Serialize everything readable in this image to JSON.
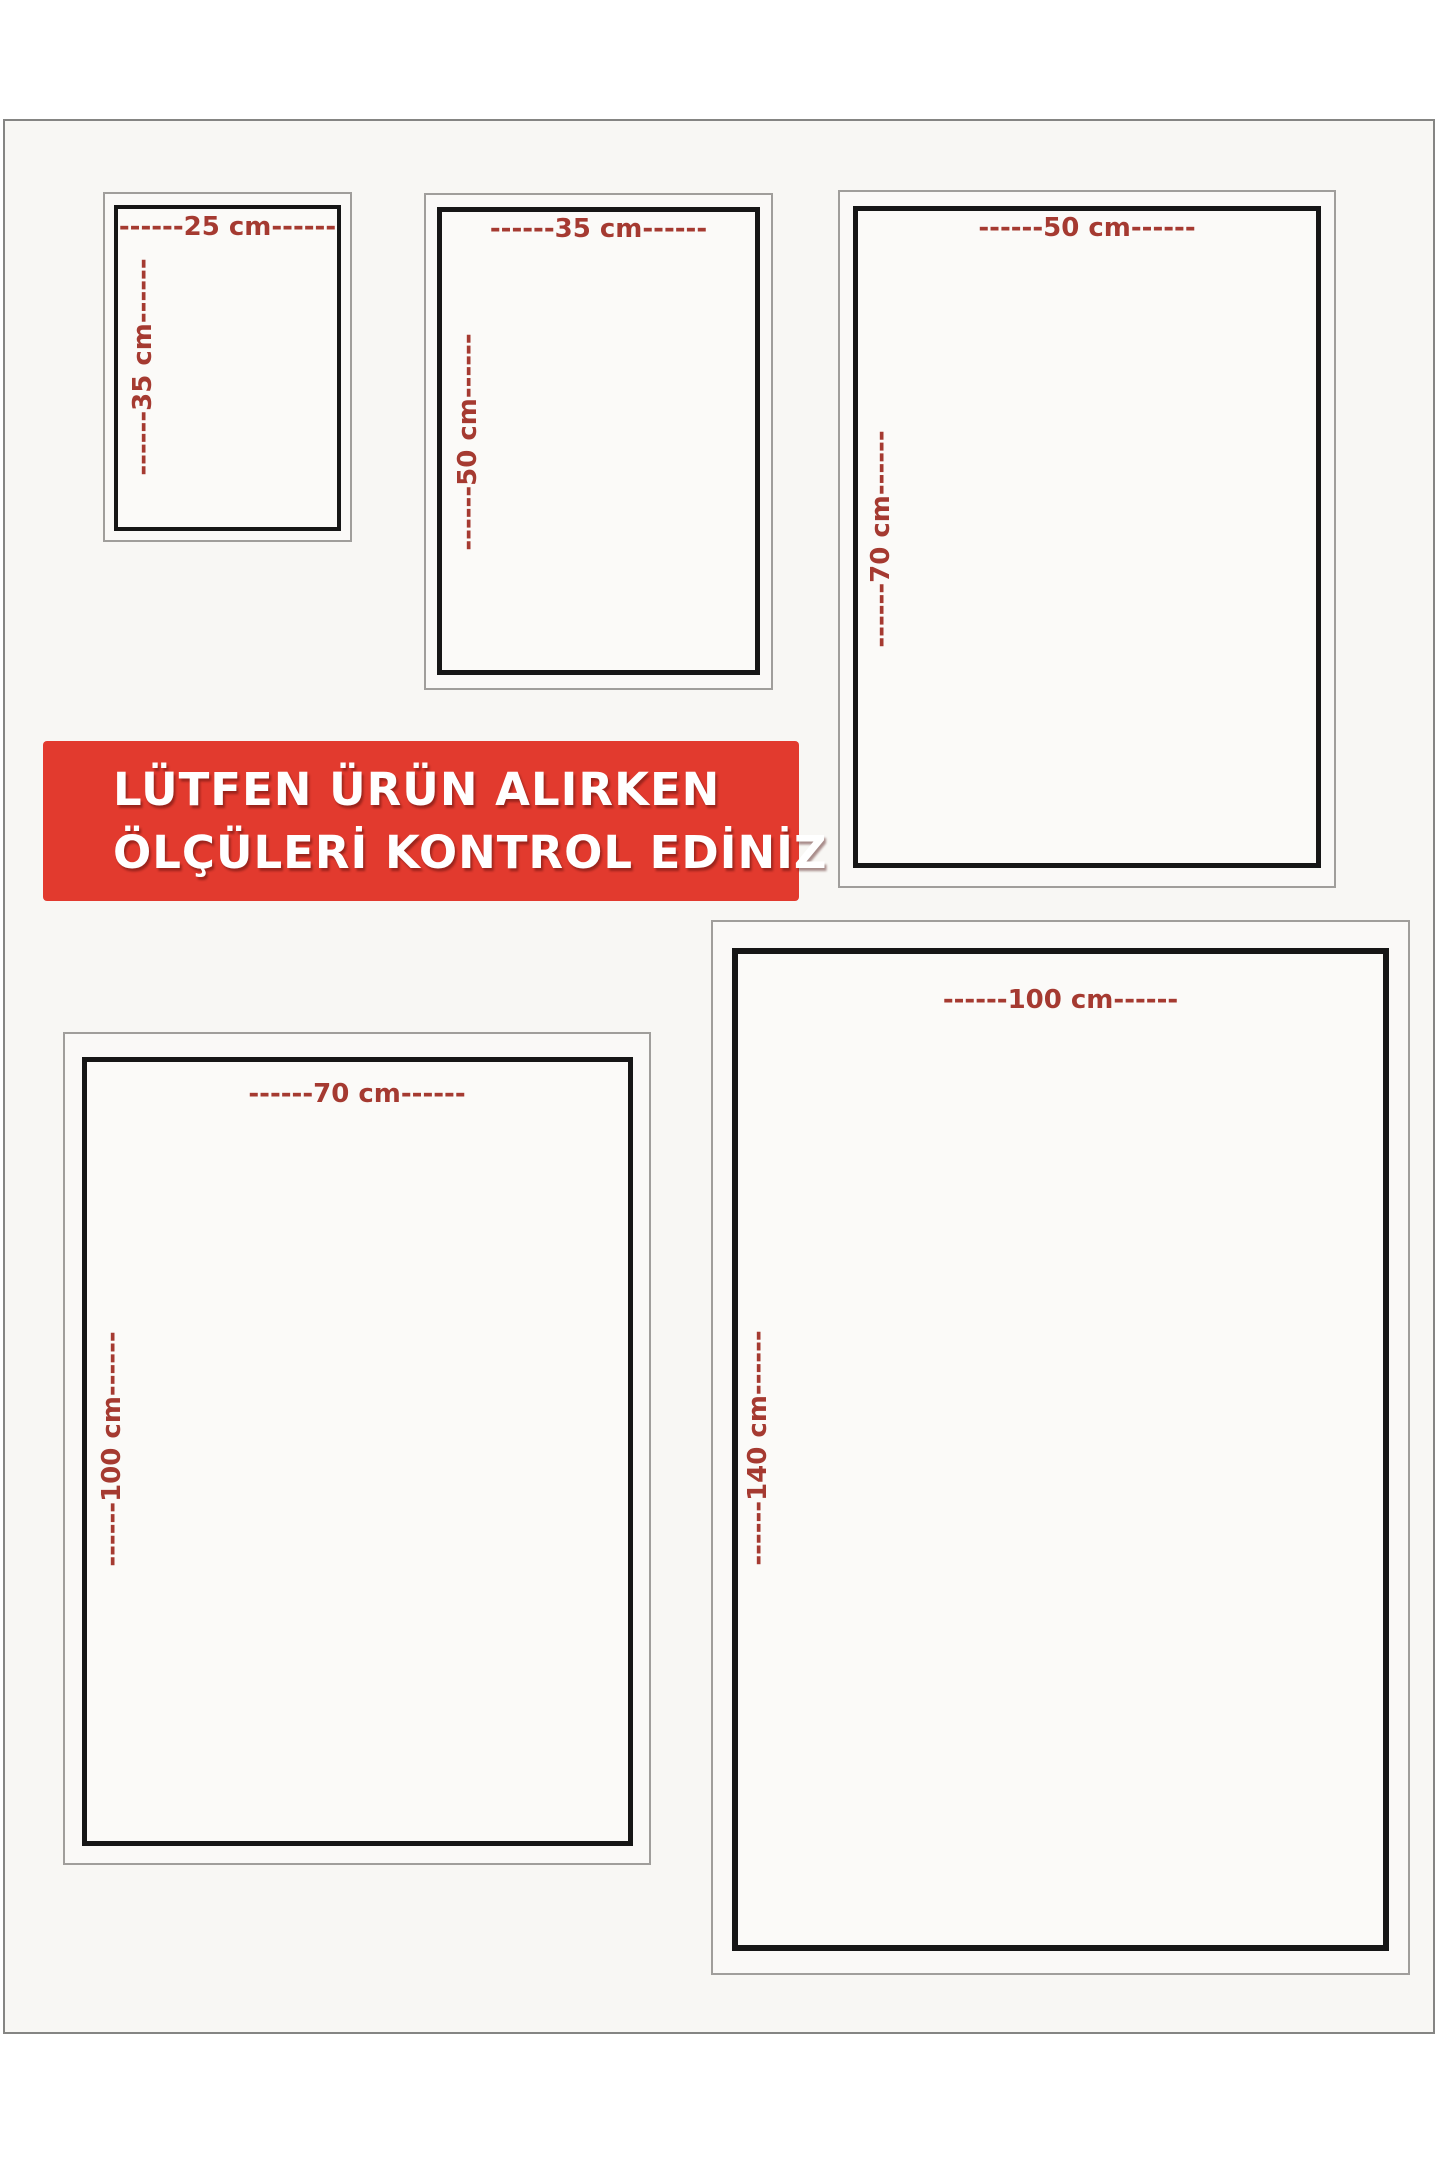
{
  "notice_banner": {
    "line1": "LÜTFEN ÜRÜN ALIRKEN",
    "line2": "ÖLÇÜLERİ KONTROL EDİNİZ",
    "background_color": "#e23a2e",
    "text_color": "#ffffff"
  },
  "colors": {
    "dimension_label_red": "#a53a31",
    "inner_frame_black": "#161616",
    "outer_frame_gray": "#a09e9b",
    "page_border_gray": "#858583",
    "page_background": "#f8f7f4"
  },
  "sizes": [
    {
      "name": "25x35 cm",
      "width_cm": 25,
      "height_cm": 35,
      "width_label": "------25 cm------",
      "height_label": "------35 cm------"
    },
    {
      "name": "35x50 cm",
      "width_cm": 35,
      "height_cm": 50,
      "width_label": "------35 cm------",
      "height_label": "------50 cm------"
    },
    {
      "name": "50x70 cm",
      "width_cm": 50,
      "height_cm": 70,
      "width_label": "------50 cm------",
      "height_label": "------70 cm------"
    },
    {
      "name": "70x100 cm",
      "width_cm": 70,
      "height_cm": 100,
      "width_label": "------70 cm------",
      "height_label": "------100 cm------"
    },
    {
      "name": "100x140 cm",
      "width_cm": 100,
      "height_cm": 140,
      "width_label": "------100 cm------",
      "height_label": "------140 cm------"
    }
  ]
}
